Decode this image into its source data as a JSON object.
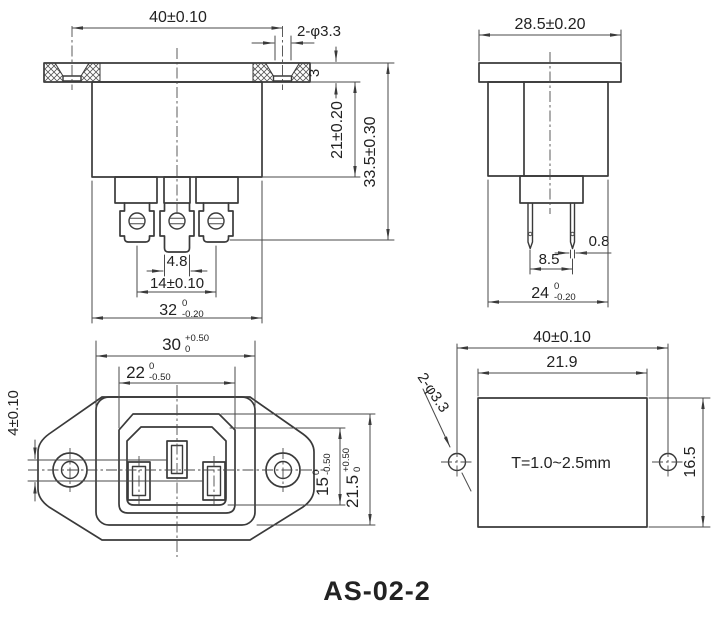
{
  "title": "AS-02-2",
  "front": {
    "flange_width": "40±0.10",
    "mount_holes": "2-φ3.3",
    "flange_thickness": "3",
    "body_depth": "21±0.20",
    "overall_depth": "33.5±0.30",
    "tab_width": "4.8",
    "terminal_spacing": "14±0.10",
    "body_width": "32",
    "body_width_tol_top": "0",
    "body_width_tol_bottom": "-0.20"
  },
  "side": {
    "flange_width": "28.5±0.20",
    "pin_thickness": "0.8",
    "pin_spacing": "8.5",
    "body_width": "24",
    "body_width_tol_top": "0",
    "body_width_tol_bottom": "-0.20"
  },
  "face": {
    "body_width": "30",
    "body_width_tol_top": "+0.50",
    "body_width_tol_bottom": "0",
    "recess_width": "22",
    "recess_width_tol_top": "0",
    "recess_width_tol_bottom": "-0.50",
    "pin_offset": "4±0.10",
    "recess_height": "15",
    "recess_height_tol_top": "0",
    "recess_height_tol_bottom": "-0.50",
    "face_height": "21.5",
    "face_height_tol_top": "+0.50",
    "face_height_tol_bottom": "0"
  },
  "cutout": {
    "hole_spacing": "40±0.10",
    "width": "21.9",
    "holes": "2-φ3.3",
    "height": "16.5",
    "panel_note": "T=1.0~2.5mm"
  },
  "colors": {
    "line": "#3a3a3a",
    "text": "#222222",
    "background": "#ffffff"
  }
}
